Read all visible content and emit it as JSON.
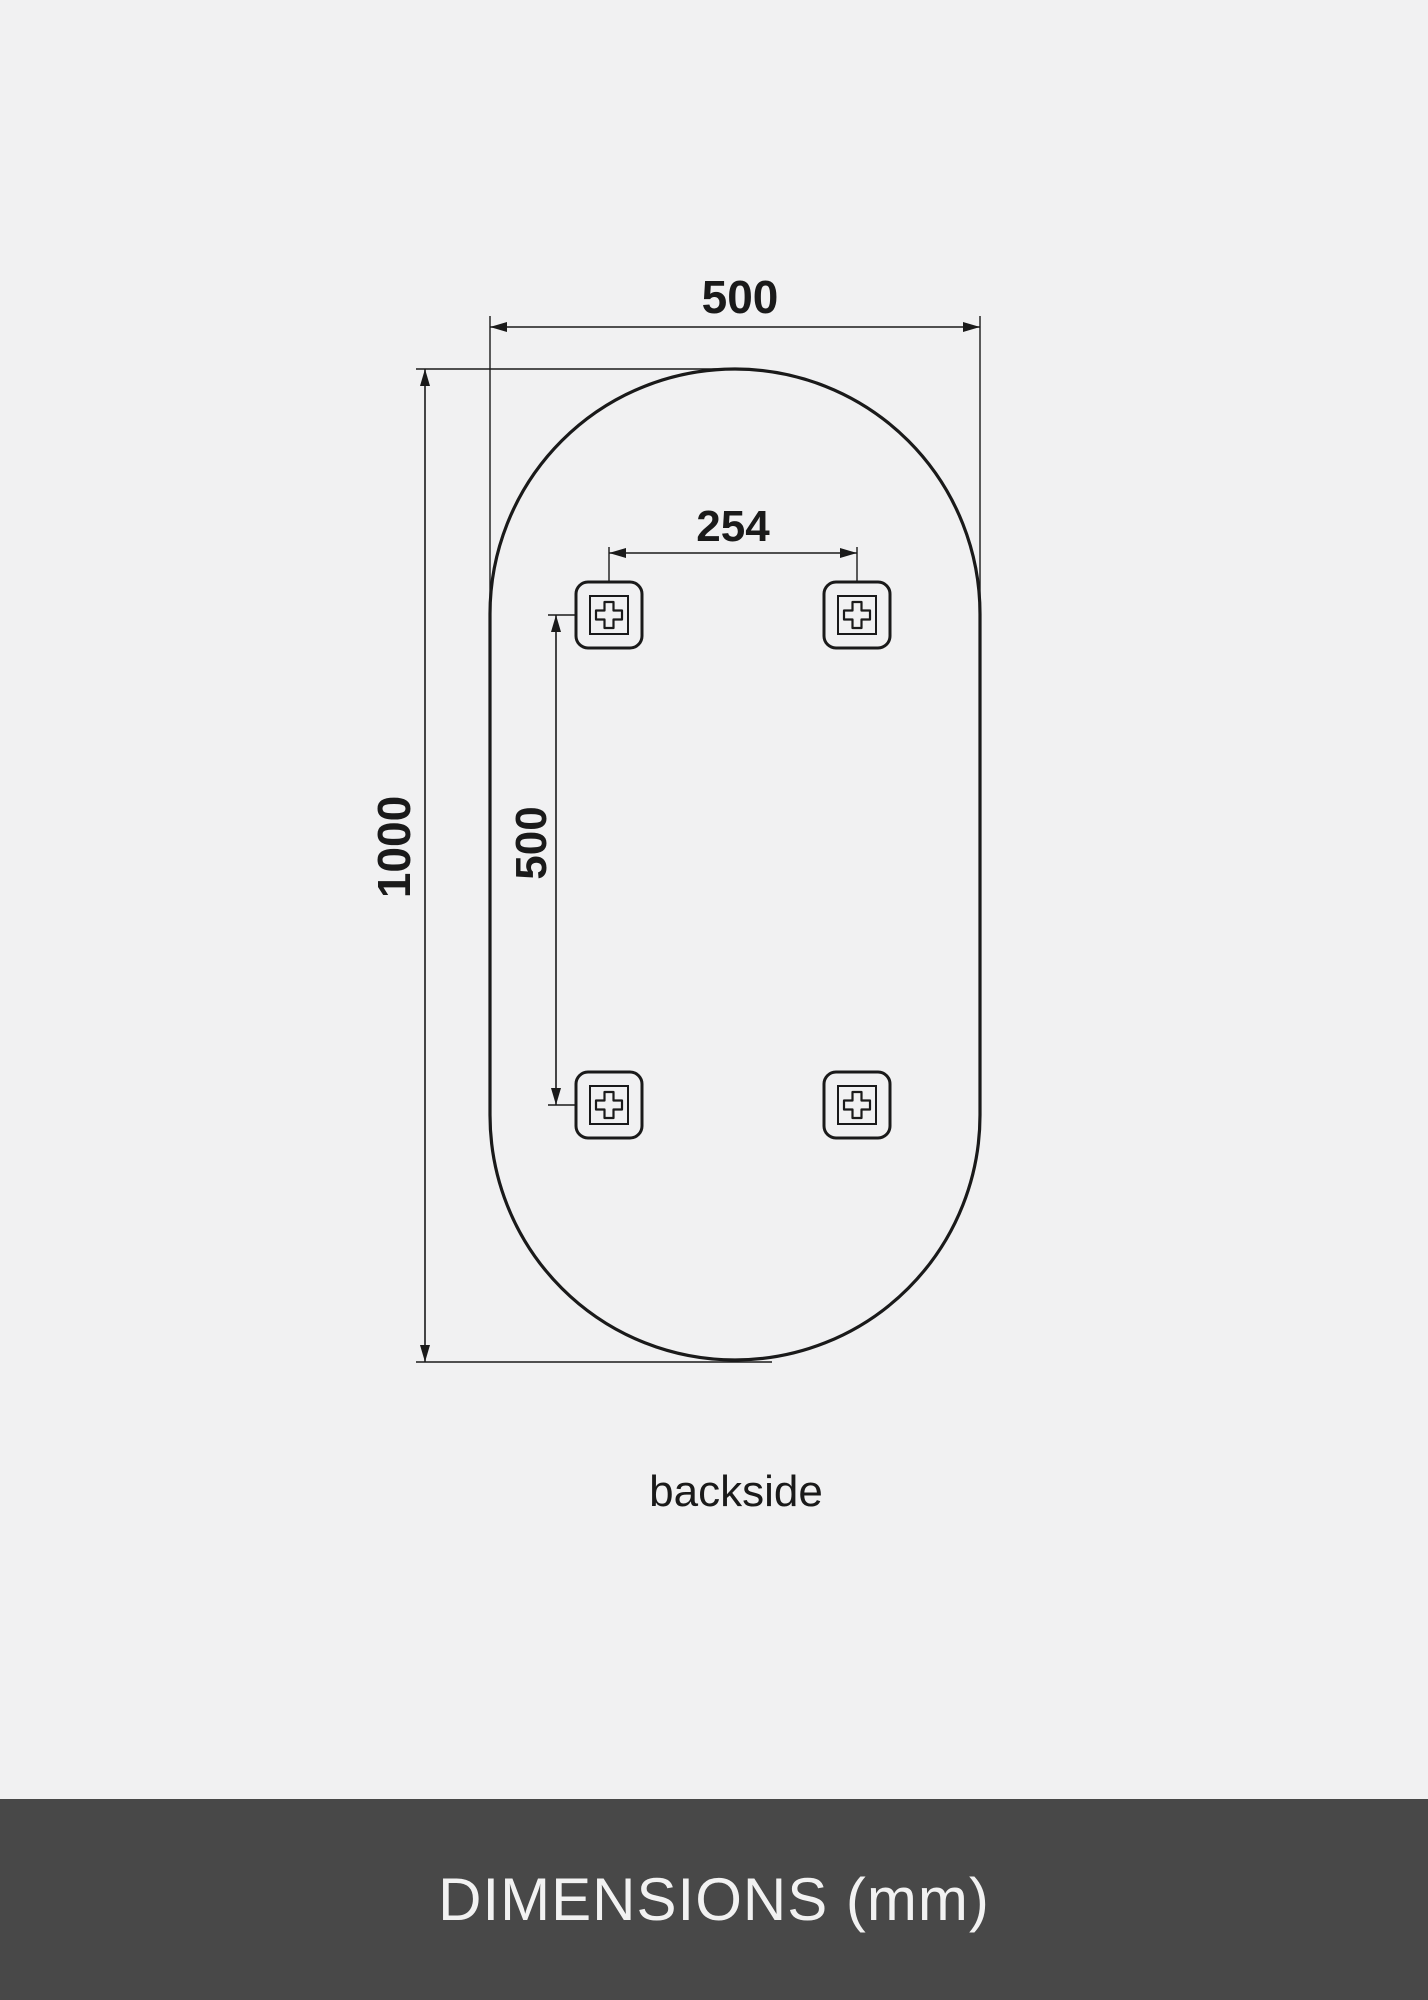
{
  "diagram": {
    "unit": "mm",
    "view_label": "backside",
    "labels": {
      "mirror_width": "500",
      "mirror_height": "1000",
      "bracket_spacing_horizontal": "254",
      "bracket_spacing_vertical": "500"
    },
    "measurements": {
      "mirror_width_mm": 500,
      "mirror_height_mm": 1000,
      "bracket_spacing_horizontal_mm": 254,
      "bracket_spacing_vertical_mm": 500,
      "bracket_count": 4,
      "shape": "pill (rounded oval, semicircular top and bottom)"
    }
  },
  "footer": {
    "title": "DIMENSIONS (mm)"
  },
  "colors": {
    "background": "#f1f1f2",
    "line": "#1a1a1a",
    "footer_background": "#484848",
    "footer_text": "#f2f2f2"
  }
}
